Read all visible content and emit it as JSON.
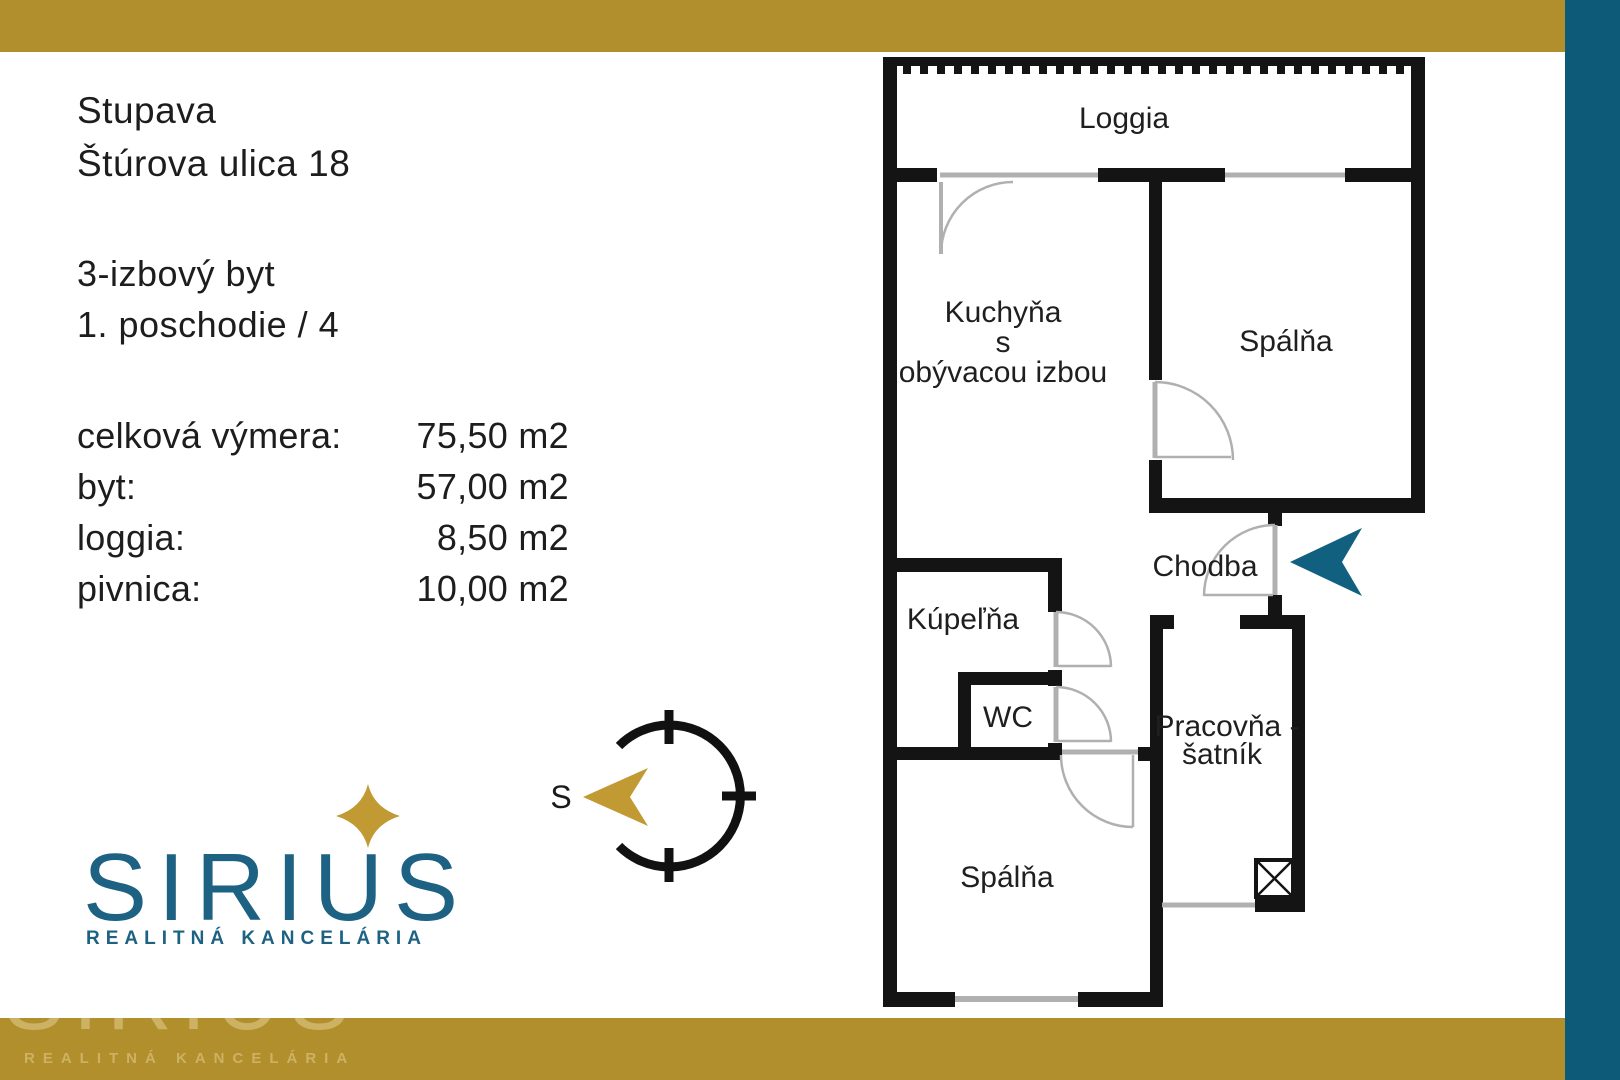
{
  "colors": {
    "gold": "#B28F2D",
    "teal_bar": "#0C5A78",
    "logo_teal": "#1D6283",
    "arrow_teal": "#11607F",
    "wall_black": "#141414",
    "door_gray": "#b0b0b0"
  },
  "header": {
    "city": "Stupava",
    "street": "Štúrova ulica 18"
  },
  "unit": {
    "type": "3-izbový byt",
    "floor": "1. poschodie / 4"
  },
  "measurements": {
    "rows": [
      {
        "label": "celková výmera:",
        "value": "75,50 m2"
      },
      {
        "label": "byt:",
        "value": "57,00 m2"
      },
      {
        "label": "loggia:",
        "value": "8,50 m2"
      },
      {
        "label": "pivnica:",
        "value": "10,00 m2"
      }
    ]
  },
  "logo": {
    "name": "SIRIUS",
    "tagline": "REALITNÁ KANCELÁRIA"
  },
  "watermark": {
    "name": "SIRIUS",
    "tagline": "REALITNÁ KANCELÁRIA"
  },
  "compass": {
    "south_label": "S"
  },
  "floorplan": {
    "rooms": {
      "loggia": "Loggia",
      "kitchen_line1": "Kuchyňa",
      "kitchen_line2": "s",
      "kitchen_line3": "obývacou izbou",
      "bedroom_top": "Spálňa",
      "hallway": "Chodba",
      "bathroom": "Kúpeľňa",
      "wc": "WC",
      "study_line1": "Pracovňa -",
      "study_line2": "šatník",
      "bedroom_bottom": "Spálňa"
    }
  }
}
